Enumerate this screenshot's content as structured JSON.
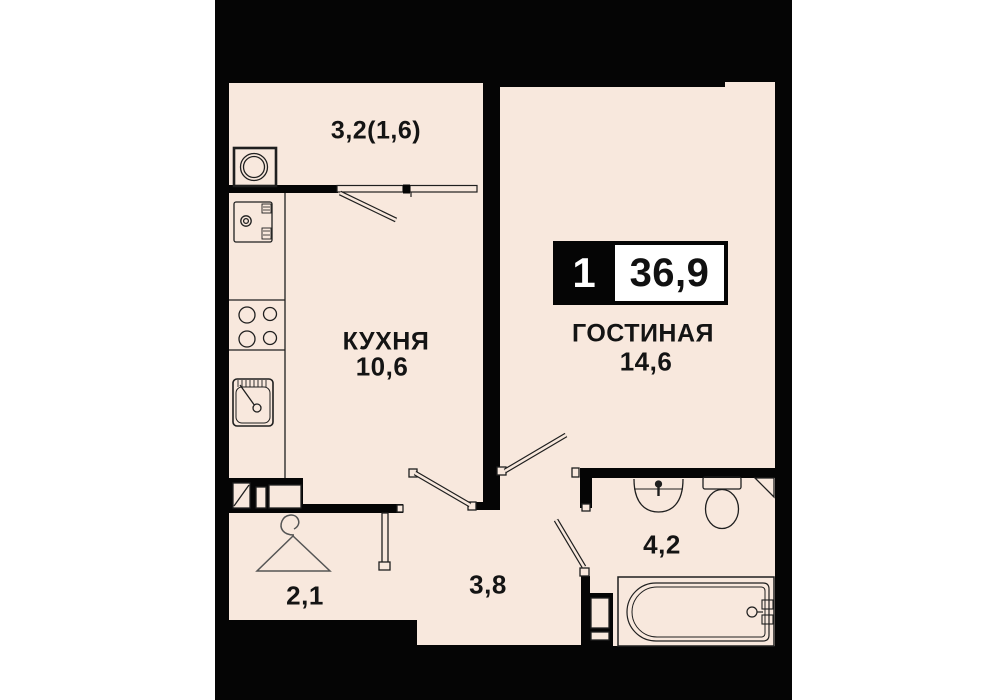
{
  "plan": {
    "title": "apartment floor plan",
    "badge": {
      "room_count": "1",
      "total_area": "36,9"
    },
    "rooms": {
      "balcony": {
        "label": "3,2(1,6)"
      },
      "kitchen": {
        "name": "КУХНЯ",
        "area": "10,6"
      },
      "living": {
        "name": "ГОСТИНАЯ",
        "area": "14,6"
      },
      "bathroom": {
        "area": "4,2"
      },
      "hallway": {
        "area": "3,8"
      },
      "entry": {
        "area": "2,1"
      }
    },
    "colors": {
      "background": "#ffffff",
      "wall": "#050505",
      "floor": "#f8e8dd",
      "line": "#1f1f1f",
      "badge_bg": "#050505",
      "badge_box": "#ffffff",
      "text": "#141414"
    },
    "icons": {
      "balcony": "washing-machine-icon",
      "kitchen": [
        "oven-icon",
        "stove-burners-icon",
        "kitchen-sink-icon"
      ],
      "bathroom": [
        "washbasin-icon",
        "toilet-icon",
        "corner-shelf-icon",
        "bathtub-icon"
      ],
      "entry": "hanger-icon"
    }
  }
}
